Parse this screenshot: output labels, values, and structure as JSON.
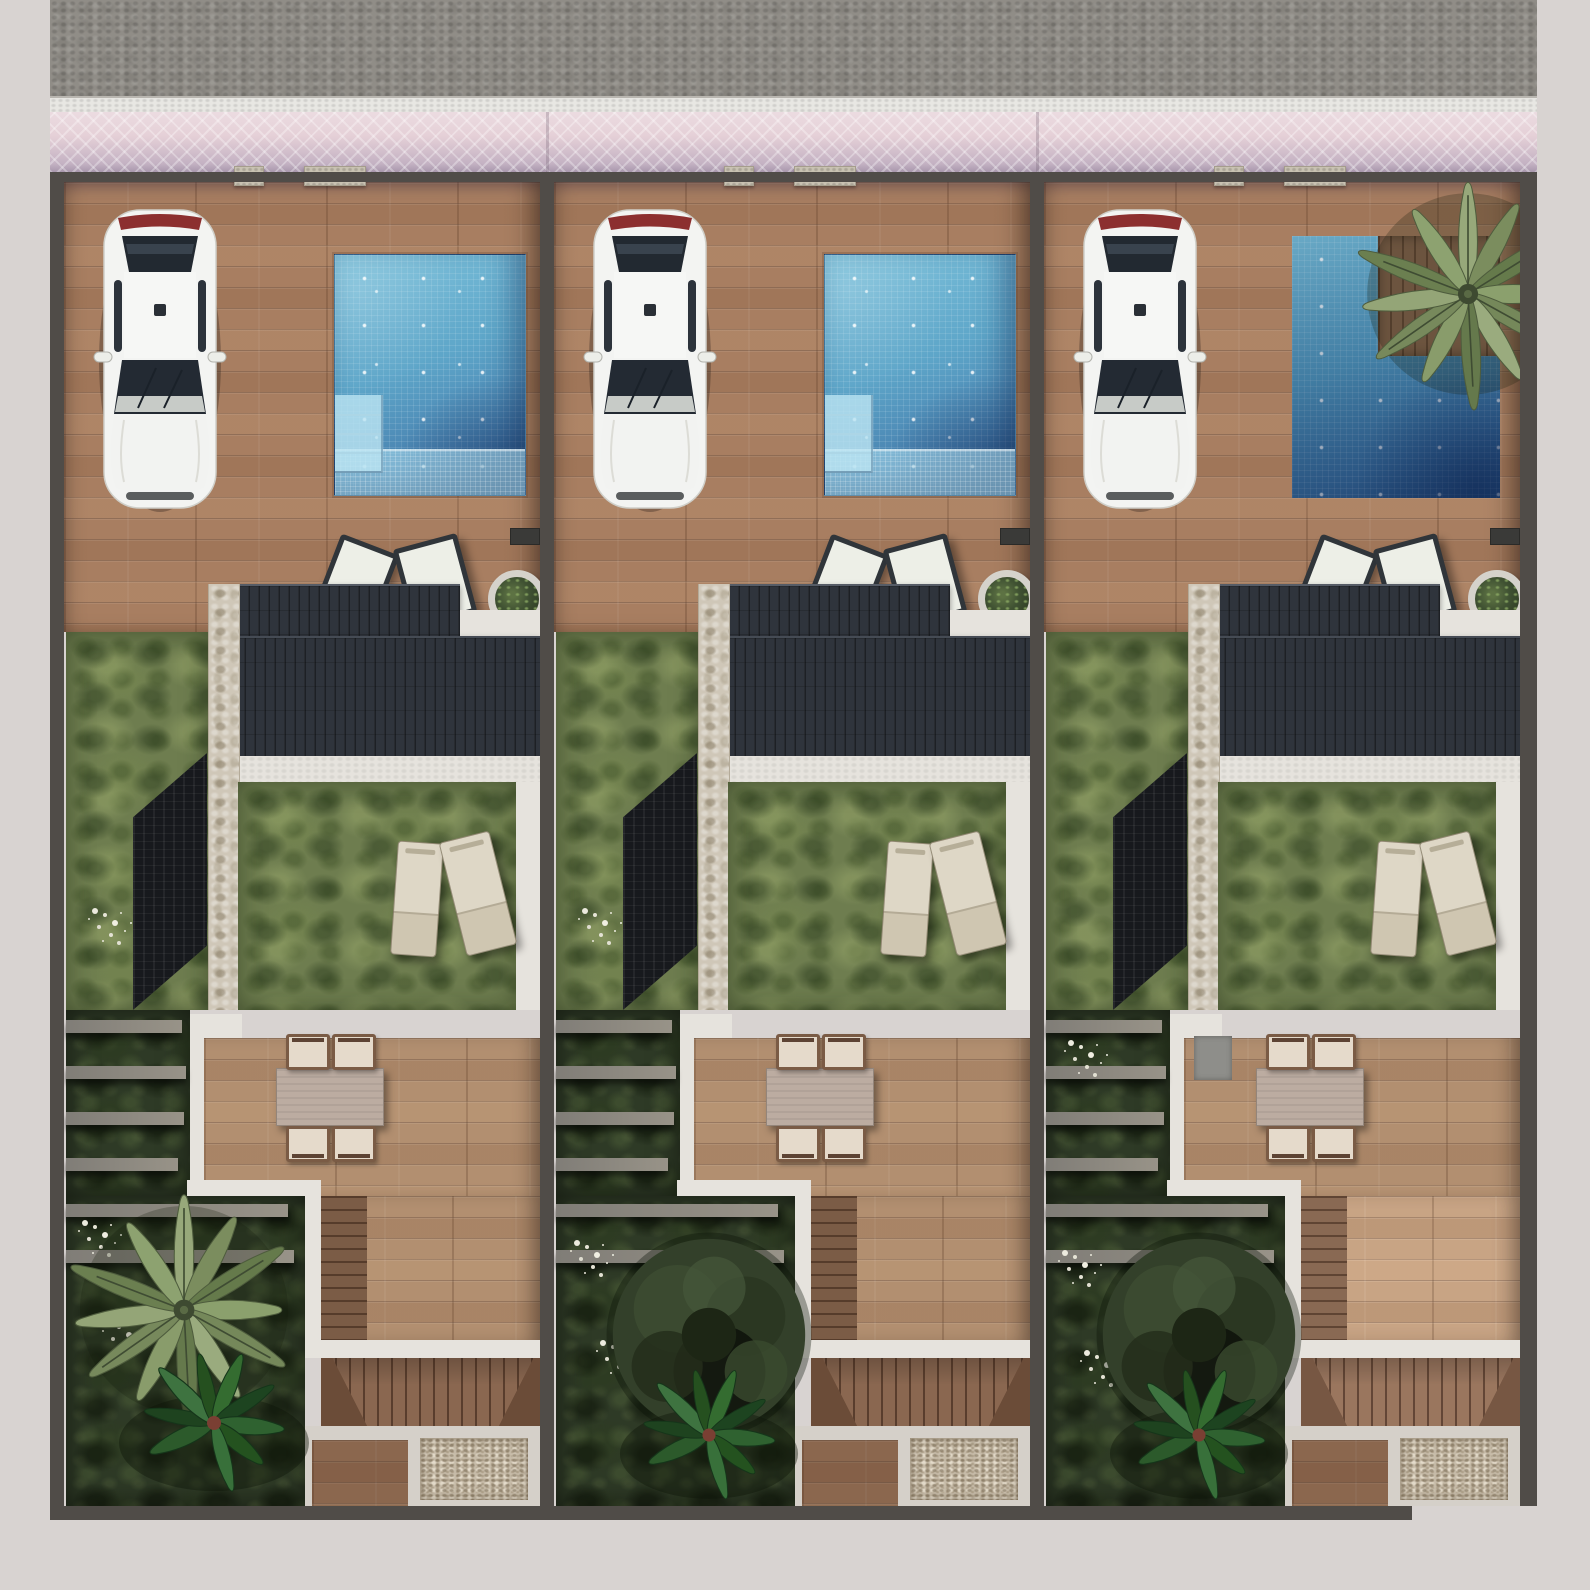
{
  "scene": {
    "description": "Aerial top-down 3D architectural site-plan rendering of three attached villa plots, street at top with pink paver sidewalk, each plot with driveway terrace, parked white car, swimming pool, dark tiled roof, rear lawn with sun loungers, outdoor dining set, terraced side garden, rear stairs and gravel service pad",
    "plot_count": 3,
    "street_position": "top"
  },
  "environment": {
    "road": "asphalt street",
    "curb": "white stone curb",
    "sidewalk": "pink herringbone paver walkway",
    "margins": "light gray surround"
  },
  "colors": {
    "margin": "#d8d3d1",
    "road": "#908d87",
    "curb": "#e8e7e3",
    "sidewalk": "#e5d0d7",
    "wall": "#504c48",
    "wood": "#a87e61",
    "terraceWood": "#b28f70",
    "stairWood": "#8a6750",
    "path": "#e6e3dd",
    "stone": "#cfc7b8",
    "lawn": "#6e7d4f",
    "garden": "#2e3a26",
    "roof": "#2f343c",
    "sideRoof": "#17191d",
    "poolLight": "#7ec2db",
    "poolDeep": "#33608f",
    "gravel": "#c6bba8",
    "concrete": "#d5d0c9",
    "pillar": "#c9c2b2",
    "table": "#bcaca1",
    "chair": "#e5dacb",
    "lounger": "#ded7c6",
    "deckSeat": "#edefe7",
    "deckFrame": "#30353a",
    "potRing": "#d5d2cb",
    "carBody": "#f3f4f2",
    "carGlass": "#232a33",
    "tailLight": "#8c2f2f",
    "palmFrond": "#7b8d5e",
    "fern": "#2c5a2b",
    "shrub": "#33402a",
    "flowers": "#eceade"
  },
  "plots": [
    {
      "id": "villa-1",
      "car": "white hatchback parked facing house",
      "pool": "square pool with corner steps and shallow shelf",
      "pool_steps": 4,
      "front_palm": false,
      "rear_vegetation": [
        "large palm tree",
        "ferns",
        "white flowers"
      ],
      "furniture": {
        "deck_chairs": 2,
        "sun_loungers": 2,
        "dining_table": 1,
        "dining_chairs": 4,
        "planter_pot": 1
      }
    },
    {
      "id": "villa-2",
      "car": "white hatchback parked facing house",
      "pool": "square pool with corner steps and shallow shelf",
      "pool_steps": 4,
      "front_palm": false,
      "rear_vegetation": [
        "dark shrub tree",
        "ferns",
        "white flowers"
      ],
      "furniture": {
        "deck_chairs": 2,
        "sun_loungers": 2,
        "dining_table": 1,
        "dining_chairs": 4,
        "planter_pot": 1
      }
    },
    {
      "id": "villa-3",
      "car": "white hatchback parked facing house",
      "pool": "L-shaped pool with wooden palm deck in notch",
      "pool_steps": 0,
      "front_palm": true,
      "rear_vegetation": [
        "dark shrub tree",
        "ferns",
        "white flowers"
      ],
      "furniture": {
        "deck_chairs": 2,
        "sun_loungers": 2,
        "dining_table": 1,
        "dining_chairs": 4,
        "planter_pot": 1,
        "entry_mat": 1
      }
    }
  ]
}
